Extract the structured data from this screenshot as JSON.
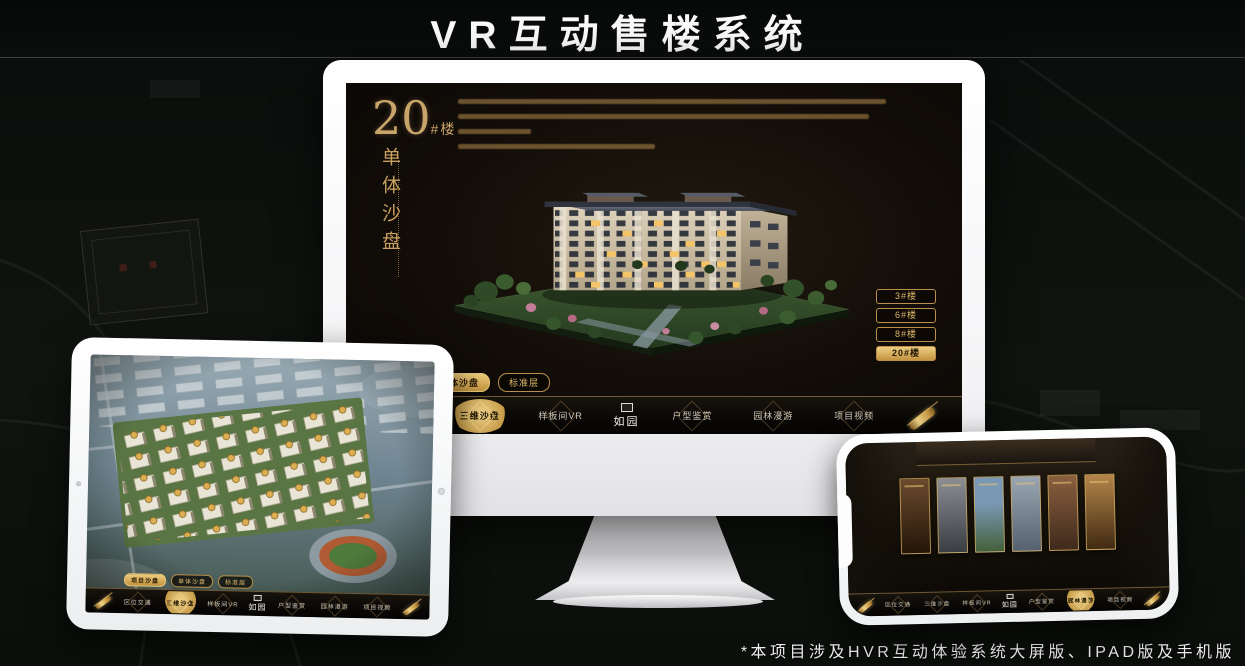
{
  "header": {
    "title": "VR互动售楼系统"
  },
  "footer": {
    "note": "*本项目涉及HVR互动体验系统大屏版、IPAD版及手机版"
  },
  "brand": {
    "logo": "如园"
  },
  "colors": {
    "gold": "#C9A05F",
    "gold_bright": "#EACD85",
    "screen_bg": "#0F0B07"
  },
  "monitor": {
    "headline": {
      "number": "20",
      "suffix": "#楼",
      "subtitle_vertical": "单体沙盘"
    },
    "floor_buttons": [
      {
        "label": "3#楼",
        "active": false
      },
      {
        "label": "6#楼",
        "active": false
      },
      {
        "label": "8#楼",
        "active": false
      },
      {
        "label": "20#楼",
        "active": true
      }
    ],
    "sub_tabs": [
      {
        "label": "项目沙盘",
        "active": false
      },
      {
        "label": "单体沙盘",
        "active": true
      },
      {
        "label": "标准层",
        "active": false
      }
    ],
    "nav_items": [
      {
        "label": "区位交通",
        "active": false
      },
      {
        "label": "三维沙盘",
        "active": true
      },
      {
        "label": "样板间VR",
        "active": false
      },
      {
        "label": "户型鉴赏",
        "active": false
      },
      {
        "label": "园林漫游",
        "active": false
      },
      {
        "label": "项目视频",
        "active": false
      }
    ]
  },
  "ipad": {
    "sub_tabs": [
      {
        "label": "项目沙盘",
        "active": true
      },
      {
        "label": "单体沙盘",
        "active": false
      },
      {
        "label": "标准层",
        "active": false
      }
    ],
    "nav_items": [
      {
        "label": "区位交通",
        "active": false
      },
      {
        "label": "三维沙盘",
        "active": true
      },
      {
        "label": "样板间VR",
        "active": false
      },
      {
        "label": "户型鉴赏",
        "active": false
      },
      {
        "label": "园林漫游",
        "active": false
      },
      {
        "label": "项目视频",
        "active": false
      }
    ]
  },
  "phone": {
    "nav_items": [
      {
        "label": "区位交通",
        "active": false
      },
      {
        "label": "三维沙盘",
        "active": false
      },
      {
        "label": "样板间VR",
        "active": false
      },
      {
        "label": "户型鉴赏",
        "active": false
      },
      {
        "label": "园林漫游",
        "active": true
      },
      {
        "label": "项目视频",
        "active": false
      }
    ]
  }
}
